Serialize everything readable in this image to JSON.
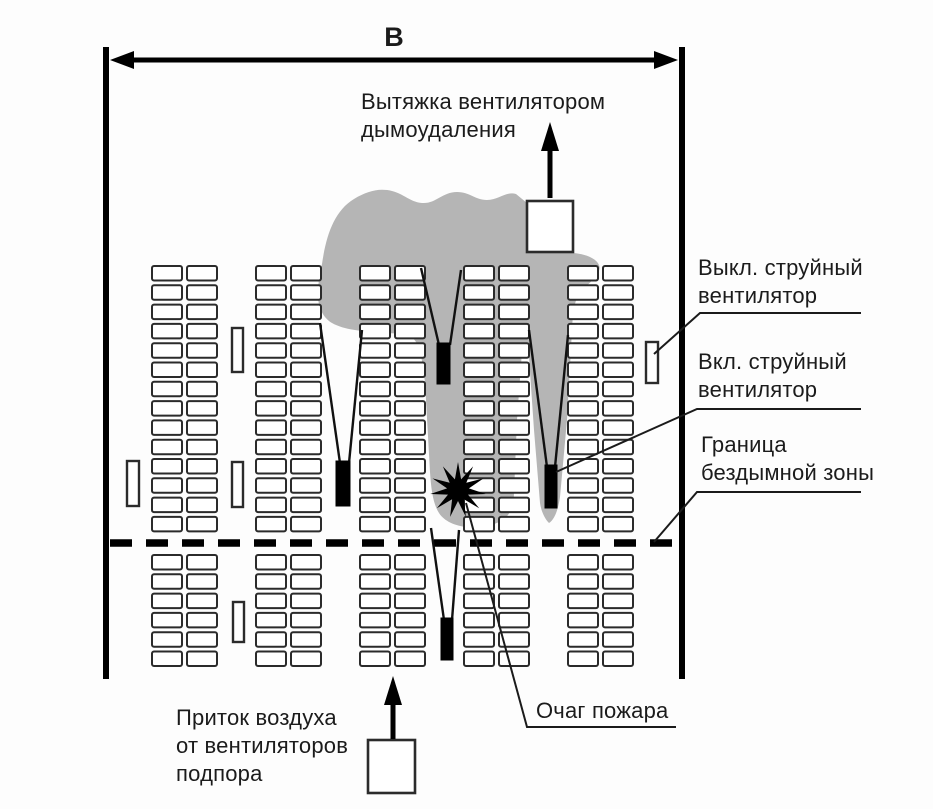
{
  "labels": {
    "dimension": "В",
    "exhaust": "Вытяжка вентилятором\nдымоудаления",
    "supply": "Приток воздуха\nот вентиляторов\nподпора",
    "jet_fan_off": "Выкл. струйный\nвентилятор",
    "jet_fan_on": "Вкл. струйный\nвентилятор",
    "smoke_free_boundary": "Граница\nбездымной зоны",
    "fire_source": "Очаг пожара"
  },
  "colors": {
    "smoke": "#b5b5b5",
    "ink": "#1b1b1b",
    "fan_on": "#000000",
    "fan_off": "#ffffff"
  }
}
